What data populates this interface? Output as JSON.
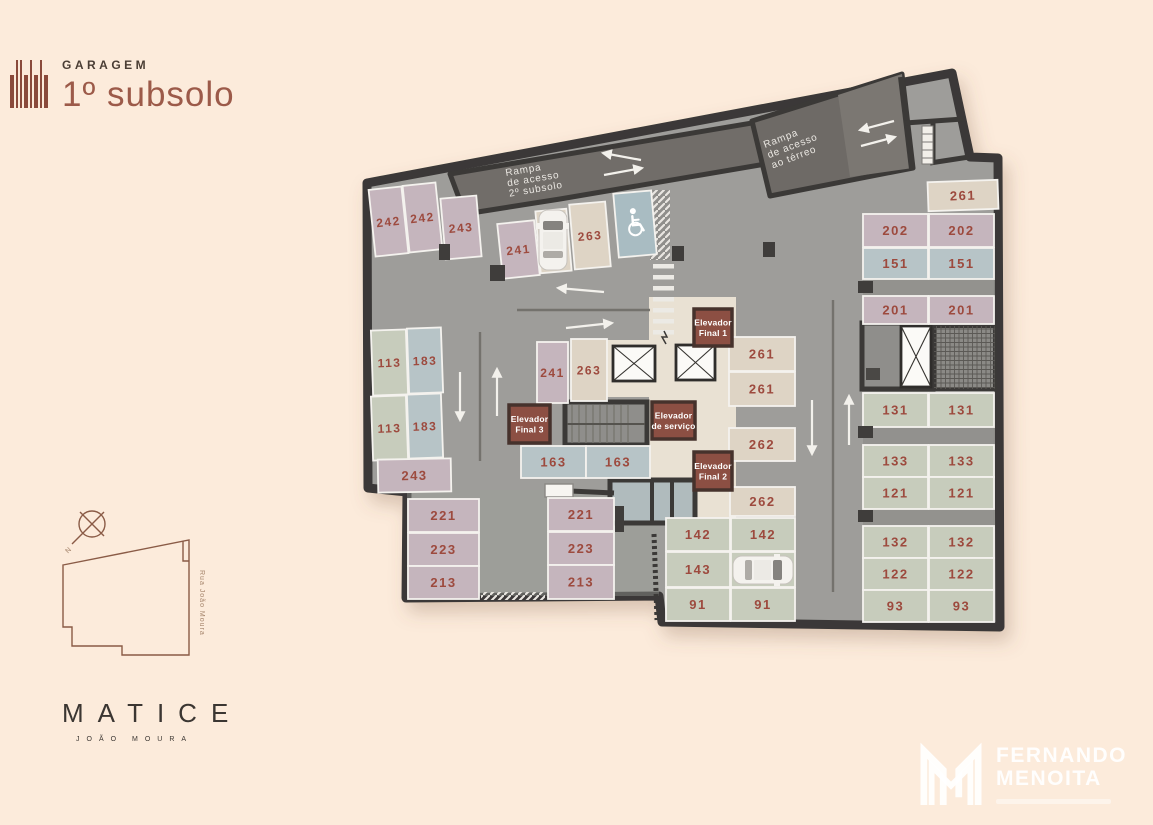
{
  "header": {
    "eyebrow": "GARAGEM",
    "title": "1º subsolo"
  },
  "plan": {
    "stall_colors": {
      "m": "#c5b5bd",
      "b": "#ded4c5",
      "g": "#c7ccbc",
      "t": "#b7c4c7"
    },
    "accent_number_color": "#9d4a3e",
    "floor_color": "#9e9d9a",
    "wall_color": "#3b3937",
    "ramps": [
      {
        "id": "ramp-subsolo",
        "lines": [
          "Rampa",
          "de acesso",
          "2º subsolo"
        ]
      },
      {
        "id": "ramp-terreo",
        "lines": [
          "Rampa",
          "de acesso",
          "ao térreo"
        ]
      }
    ],
    "elevators": [
      {
        "lines": [
          "Elevador",
          "Final 1"
        ],
        "x": 694,
        "y": 309,
        "w": 38,
        "h": 37
      },
      {
        "lines": [
          "Elevador",
          "de serviço"
        ],
        "x": 652,
        "y": 402,
        "w": 43,
        "h": 37
      },
      {
        "lines": [
          "Elevador",
          "Final 2"
        ],
        "x": 694,
        "y": 452,
        "w": 38,
        "h": 38
      },
      {
        "lines": [
          "Elevador",
          "Final 3"
        ],
        "x": 509,
        "y": 405,
        "w": 41,
        "h": 38
      }
    ],
    "accessible_stall": {
      "x": 616,
      "y": 192,
      "w": 38,
      "h": 64
    },
    "stalls": [
      {
        "label": "242",
        "x": 372,
        "y": 188,
        "w": 33,
        "h": 67,
        "c": "m",
        "rot": -6,
        "fs": 12
      },
      {
        "label": "242",
        "x": 406,
        "y": 184,
        "w": 33,
        "h": 67,
        "c": "m",
        "rot": -6,
        "fs": 12
      },
      {
        "label": "243",
        "x": 443,
        "y": 197,
        "w": 36,
        "h": 61,
        "c": "m",
        "rot": -5,
        "fs": 12
      },
      {
        "label": "241",
        "x": 500,
        "y": 222,
        "w": 37,
        "h": 55,
        "c": "m",
        "rot": -6,
        "fs": 12
      },
      {
        "label": "263",
        "x": 538,
        "y": 210,
        "w": 31,
        "h": 62,
        "c": "b",
        "rot": -5,
        "fs": 12
      },
      {
        "label": "263",
        "x": 572,
        "y": 203,
        "w": 36,
        "h": 65,
        "c": "b",
        "rot": -5,
        "fs": 12
      },
      {
        "label": "113",
        "x": 372,
        "y": 330,
        "w": 35,
        "h": 65,
        "c": "g",
        "rot": -2,
        "fs": 12
      },
      {
        "label": "183",
        "x": 408,
        "y": 328,
        "w": 34,
        "h": 65,
        "c": "t",
        "rot": -2,
        "fs": 12
      },
      {
        "label": "113",
        "x": 372,
        "y": 396,
        "w": 35,
        "h": 64,
        "c": "g",
        "rot": -2,
        "fs": 12
      },
      {
        "label": "183",
        "x": 408,
        "y": 394,
        "w": 34,
        "h": 64,
        "c": "t",
        "rot": -2,
        "fs": 12
      },
      {
        "label": "243",
        "x": 378,
        "y": 459,
        "w": 73,
        "h": 33,
        "c": "m",
        "rot": -1,
        "fs": 13
      },
      {
        "label": "241",
        "x": 537,
        "y": 342,
        "w": 31,
        "h": 61,
        "c": "m",
        "rot": 0,
        "fs": 12
      },
      {
        "label": "263",
        "x": 571,
        "y": 339,
        "w": 36,
        "h": 62,
        "c": "b",
        "rot": 0,
        "fs": 12
      },
      {
        "label": "163",
        "x": 521,
        "y": 446,
        "w": 65,
        "h": 32,
        "c": "t",
        "fs": 13
      },
      {
        "label": "163",
        "x": 586,
        "y": 446,
        "w": 64,
        "h": 32,
        "c": "t",
        "fs": 13
      },
      {
        "label": "221",
        "x": 408,
        "y": 499,
        "w": 71,
        "h": 33,
        "c": "m"
      },
      {
        "label": "223",
        "x": 408,
        "y": 533,
        "w": 71,
        "h": 33,
        "c": "m"
      },
      {
        "label": "213",
        "x": 408,
        "y": 566,
        "w": 71,
        "h": 33,
        "c": "m"
      },
      {
        "label": "221",
        "x": 548,
        "y": 498,
        "w": 66,
        "h": 33,
        "c": "m"
      },
      {
        "label": "223",
        "x": 548,
        "y": 532,
        "w": 66,
        "h": 33,
        "c": "m"
      },
      {
        "label": "213",
        "x": 548,
        "y": 565,
        "w": 66,
        "h": 34,
        "c": "m"
      },
      {
        "label": "261",
        "x": 729,
        "y": 337,
        "w": 66,
        "h": 34,
        "c": "b"
      },
      {
        "label": "261",
        "x": 729,
        "y": 372,
        "w": 66,
        "h": 34,
        "c": "b"
      },
      {
        "label": "262",
        "x": 729,
        "y": 428,
        "w": 66,
        "h": 33,
        "c": "b"
      },
      {
        "label": "262",
        "x": 730,
        "y": 487,
        "w": 65,
        "h": 29,
        "c": "b"
      },
      {
        "label": "142",
        "x": 666,
        "y": 518,
        "w": 64,
        "h": 33,
        "c": "g"
      },
      {
        "label": "142",
        "x": 731,
        "y": 518,
        "w": 64,
        "h": 33,
        "c": "g"
      },
      {
        "label": "143",
        "x": 666,
        "y": 552,
        "w": 64,
        "h": 35,
        "c": "g"
      },
      {
        "label": "143",
        "x": 731,
        "y": 552,
        "w": 64,
        "h": 35,
        "c": "g"
      },
      {
        "label": "91",
        "x": 666,
        "y": 588,
        "w": 64,
        "h": 33,
        "c": "g"
      },
      {
        "label": "91",
        "x": 731,
        "y": 588,
        "w": 64,
        "h": 33,
        "c": "g"
      },
      {
        "label": "261",
        "x": 928,
        "y": 181,
        "w": 70,
        "h": 29,
        "c": "b",
        "rot": -2
      },
      {
        "label": "202",
        "x": 863,
        "y": 214,
        "w": 65,
        "h": 33,
        "c": "m"
      },
      {
        "label": "202",
        "x": 929,
        "y": 214,
        "w": 65,
        "h": 33,
        "c": "m"
      },
      {
        "label": "151",
        "x": 863,
        "y": 248,
        "w": 65,
        "h": 31,
        "c": "t"
      },
      {
        "label": "151",
        "x": 929,
        "y": 248,
        "w": 65,
        "h": 31,
        "c": "t"
      },
      {
        "label": "201",
        "x": 863,
        "y": 296,
        "w": 65,
        "h": 28,
        "c": "m"
      },
      {
        "label": "201",
        "x": 929,
        "y": 296,
        "w": 65,
        "h": 28,
        "c": "m"
      },
      {
        "label": "131",
        "x": 863,
        "y": 393,
        "w": 65,
        "h": 34,
        "c": "g"
      },
      {
        "label": "131",
        "x": 929,
        "y": 393,
        "w": 65,
        "h": 34,
        "c": "g"
      },
      {
        "label": "133",
        "x": 863,
        "y": 445,
        "w": 65,
        "h": 32,
        "c": "g"
      },
      {
        "label": "133",
        "x": 929,
        "y": 445,
        "w": 65,
        "h": 32,
        "c": "g"
      },
      {
        "label": "121",
        "x": 863,
        "y": 477,
        "w": 65,
        "h": 32,
        "c": "g"
      },
      {
        "label": "121",
        "x": 929,
        "y": 477,
        "w": 65,
        "h": 32,
        "c": "g"
      },
      {
        "label": "132",
        "x": 863,
        "y": 526,
        "w": 65,
        "h": 32,
        "c": "g"
      },
      {
        "label": "132",
        "x": 929,
        "y": 526,
        "w": 65,
        "h": 32,
        "c": "g"
      },
      {
        "label": "122",
        "x": 863,
        "y": 558,
        "w": 65,
        "h": 32,
        "c": "g"
      },
      {
        "label": "122",
        "x": 929,
        "y": 558,
        "w": 65,
        "h": 32,
        "c": "g"
      },
      {
        "label": "93",
        "x": 863,
        "y": 590,
        "w": 65,
        "h": 32,
        "c": "g"
      },
      {
        "label": "93",
        "x": 929,
        "y": 590,
        "w": 65,
        "h": 32,
        "c": "g"
      }
    ]
  },
  "siteplan": {
    "street": "Rua João Moura",
    "north_label": "N"
  },
  "brand": {
    "name": "MATICE",
    "subtitle": "JOÃO MOURA"
  },
  "agency": {
    "line1": "FERNANDO",
    "line2": "MENOITA"
  }
}
